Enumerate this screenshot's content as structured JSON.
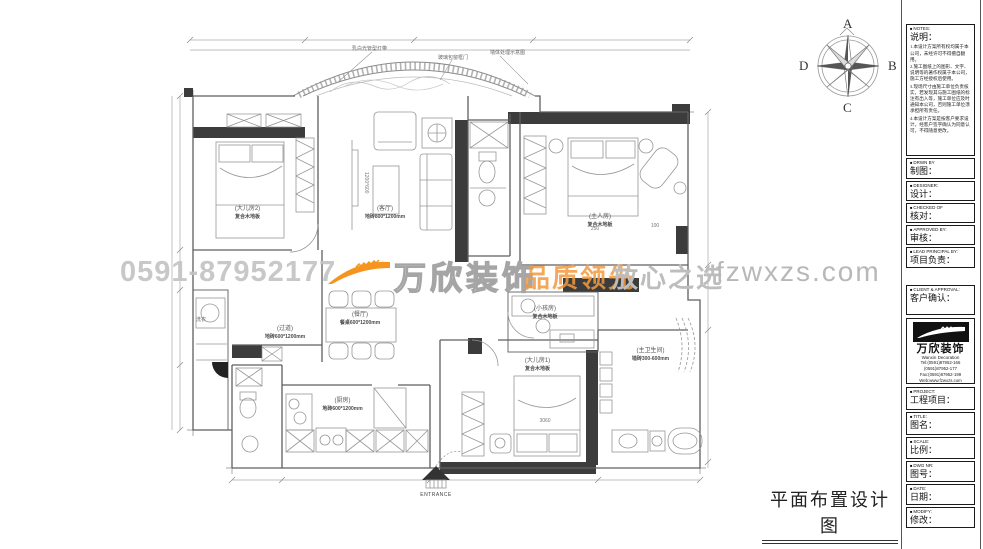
{
  "drawing_title": "平面布置设计图",
  "watermark": {
    "phone": "0591-87952177",
    "brand": "万欣装饰",
    "slogan_left": "品质领先",
    "slogan_right": "放心之选",
    "website": "fzwxzs.com",
    "orange": "#f5951f",
    "gray": "#bdbdbd"
  },
  "compass": {
    "north": "A",
    "east": "B",
    "south": "C",
    "west": "D"
  },
  "annotations": {
    "arc_left": "乳白光管型灯带",
    "arc_mid": "玻璃包窗框门",
    "arc_right": "墙体处理示意图",
    "entrance": "ENTRANCE",
    "laundry": "洗衣"
  },
  "dimensions": {
    "bed_bottom": "3060",
    "master_a": "250",
    "master_b": "100",
    "coffee_table": "1200*600"
  },
  "rooms": {
    "bedroom2": {
      "label": "(大儿房2)",
      "sub": "复合木地板"
    },
    "living": {
      "label": "(客厅)",
      "sub": "地砖800*1200mm"
    },
    "master": {
      "label": "(主人房)",
      "sub": "复合木地板"
    },
    "dining": {
      "label": "(餐厅)",
      "sub": "餐桌600*1200mm"
    },
    "hallway": {
      "label": "(过道)",
      "sub": "地砖600*1200mm"
    },
    "kitchen": {
      "label": "(厨房)",
      "sub": "地砖600*1200mm"
    },
    "bedroom1": {
      "label": "(大儿房1)",
      "sub": "复合木地板"
    },
    "kids": {
      "label": "(小孩房)",
      "sub": "复合木地板"
    },
    "master_bath": {
      "label": "(主卫生间)",
      "sub": "墙砖300-600mm"
    }
  },
  "titleblock": {
    "notes": {
      "en": "NOTES:",
      "title": "说明：",
      "items": [
        "1.本设计方案所有权均属于本公司，未经许可不得擅自翻用。",
        "2.施工图纸上的图形、文字、说明等的著作权属于本公司，施工方经授权后使用。",
        "3.现场尺寸由施工单位负责核实，若发现其与施工图纸的标注有出入等，施工单位应及时通知本公司，否则施工单位须承担所有责任。",
        "4.本设计方案是按客户要求设计，经客户签字确认为同意认可，不得随意更改。"
      ]
    },
    "sections": [
      {
        "en": "DRWN BY",
        "zh": "制图："
      },
      {
        "en": "DESIGNER:",
        "zh": "设计："
      },
      {
        "en": "CHECKED OF",
        "zh": "核对："
      },
      {
        "en": "APPROVED BY:",
        "zh": "审核："
      },
      {
        "en": "LEAD PRINCIPAL BY:",
        "zh": "项目负责："
      },
      {
        "en": "CLIENT & APPROVAL:",
        "zh": "客户确认："
      },
      {
        "en": "PROJECT:",
        "zh": "工程项目："
      },
      {
        "en": "TITLE:",
        "zh": "图名："
      },
      {
        "en": "SCALE:",
        "zh": "比例："
      },
      {
        "en": "DWG NR:",
        "zh": "图号："
      },
      {
        "en": "DATE:",
        "zh": "日期："
      },
      {
        "en": "MODIFY:",
        "zh": "修改："
      }
    ],
    "logo": {
      "brand": "万欣装饰",
      "brand_en": "Wanxin Decoration",
      "tel1": "Tel:(0591)87952-166",
      "tel2": "(0591)87952-177",
      "fax": "Fax:(0591)87952-199",
      "web": "Web:www.fzwxzs.com"
    }
  }
}
